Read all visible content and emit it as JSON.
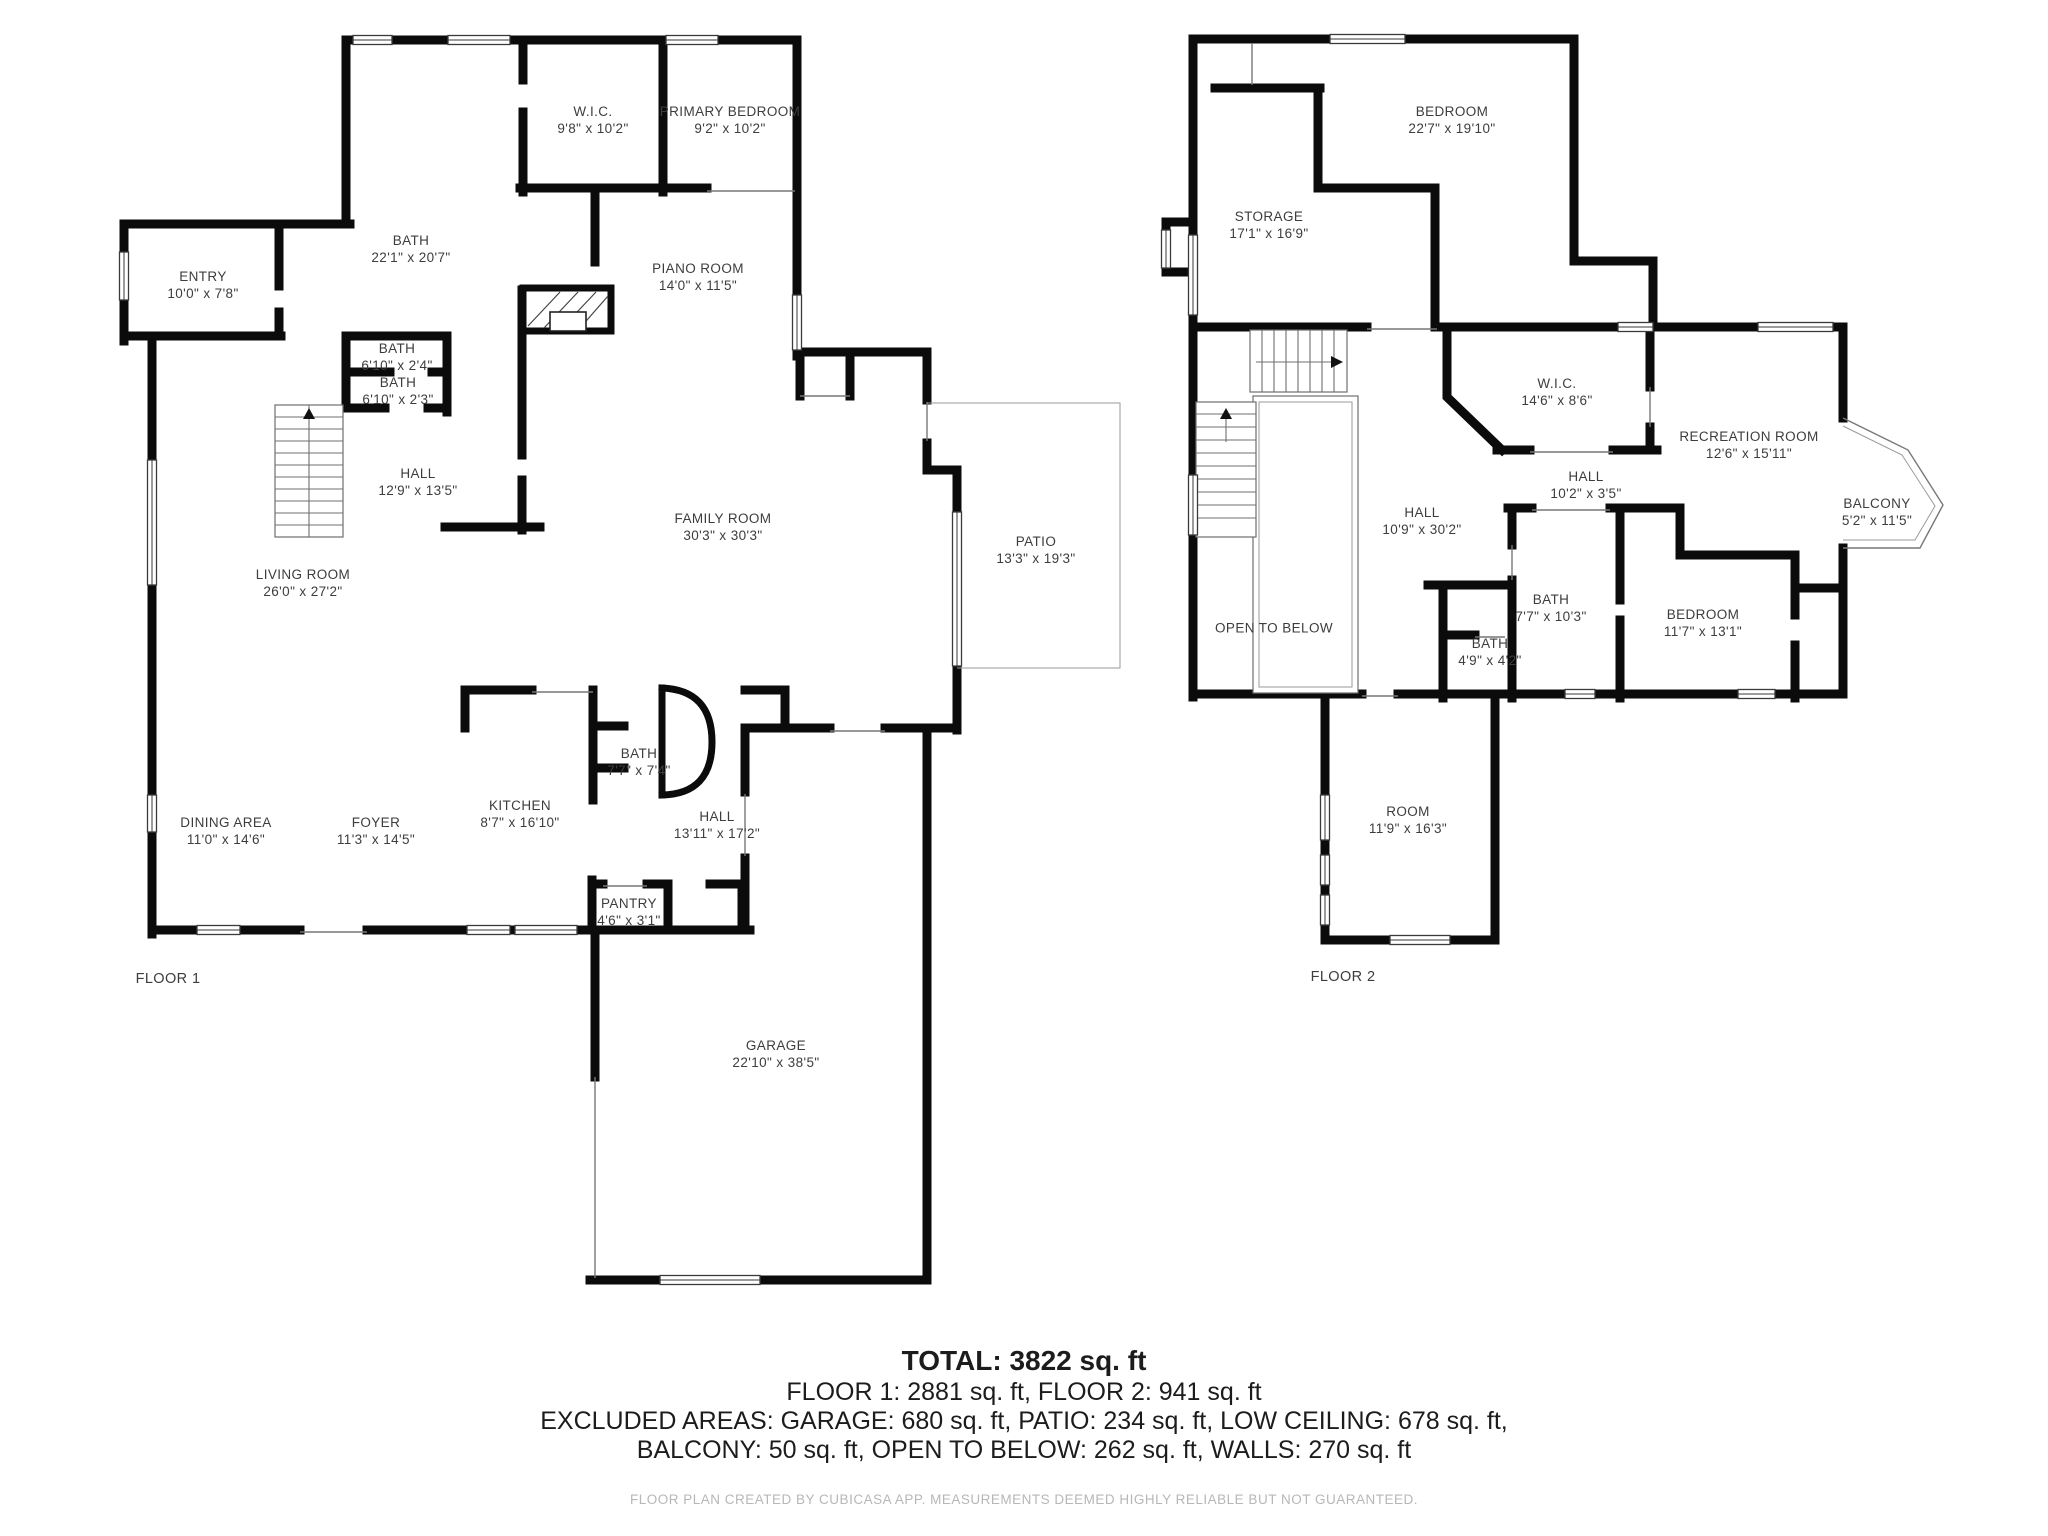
{
  "floor1": {
    "label": "FLOOR 1",
    "rooms": [
      {
        "name": "W.I.C.",
        "dims": "9'8\" x 10'2\""
      },
      {
        "name": "PRIMARY BEDROOM",
        "dims": "9'2\" x 10'2\""
      },
      {
        "name": "BATH",
        "dims": "22'1\" x 20'7\""
      },
      {
        "name": "ENTRY",
        "dims": "10'0\" x 7'8\""
      },
      {
        "name": "PIANO ROOM",
        "dims": "14'0\" x 11'5\""
      },
      {
        "name": "BATH",
        "dims": "6'10\" x 2'4\""
      },
      {
        "name": "BATH",
        "dims": "6'10\" x 2'3\""
      },
      {
        "name": "HALL",
        "dims": "12'9\" x 13'5\""
      },
      {
        "name": "FAMILY ROOM",
        "dims": "30'3\" x 30'3\""
      },
      {
        "name": "LIVING ROOM",
        "dims": "26'0\" x 27'2\""
      },
      {
        "name": "PATIO",
        "dims": "13'3\" x 19'3\""
      },
      {
        "name": "DINING AREA",
        "dims": "11'0\" x 14'6\""
      },
      {
        "name": "FOYER",
        "dims": "11'3\" x 14'5\""
      },
      {
        "name": "KITCHEN",
        "dims": "8'7\" x 16'10\""
      },
      {
        "name": "BATH",
        "dims": "7'7\" x 7'4\""
      },
      {
        "name": "HALL",
        "dims": "13'11\" x 17'2\""
      },
      {
        "name": "PANTRY",
        "dims": "4'6\" x 3'1\""
      },
      {
        "name": "GARAGE",
        "dims": "22'10\" x 38'5\""
      }
    ]
  },
  "floor2": {
    "label": "FLOOR 2",
    "rooms": [
      {
        "name": "BEDROOM",
        "dims": "22'7\" x 19'10\""
      },
      {
        "name": "STORAGE",
        "dims": "17'1\" x 16'9\""
      },
      {
        "name": "W.I.C.",
        "dims": "14'6\" x 8'6\""
      },
      {
        "name": "RECREATION ROOM",
        "dims": "12'6\" x 15'11\""
      },
      {
        "name": "BALCONY",
        "dims": "5'2\" x 11'5\""
      },
      {
        "name": "HALL",
        "dims": "10'2\" x 3'5\""
      },
      {
        "name": "HALL",
        "dims": "10'9\" x 30'2\""
      },
      {
        "name": "BATH",
        "dims": "7'7\" x 10'3\""
      },
      {
        "name": "BATH",
        "dims": "4'9\" x 4'2\""
      },
      {
        "name": "BEDROOM",
        "dims": "11'7\" x 13'1\""
      },
      {
        "name": "OPEN TO BELOW",
        "dims": ""
      },
      {
        "name": "ROOM",
        "dims": "11'9\" x 16'3\""
      }
    ]
  },
  "summary": {
    "total": "TOTAL: 3822 sq. ft",
    "line2": "FLOOR 1: 2881 sq. ft, FLOOR 2: 941 sq. ft",
    "line3": "EXCLUDED AREAS: GARAGE: 680 sq. ft, PATIO: 234 sq. ft, LOW CEILING: 678 sq. ft,",
    "line4": "BALCONY: 50 sq. ft, OPEN TO BELOW: 262 sq. ft, WALLS: 270 sq. ft"
  },
  "footer": "FLOOR PLAN CREATED BY CUBICASA APP. MEASUREMENTS DEEMED HIGHLY RELIABLE BUT NOT GUARANTEED.",
  "colors": {
    "wall": "#0b0b0b",
    "label": "#3d3d3d",
    "footer": "#b7b7b7"
  }
}
